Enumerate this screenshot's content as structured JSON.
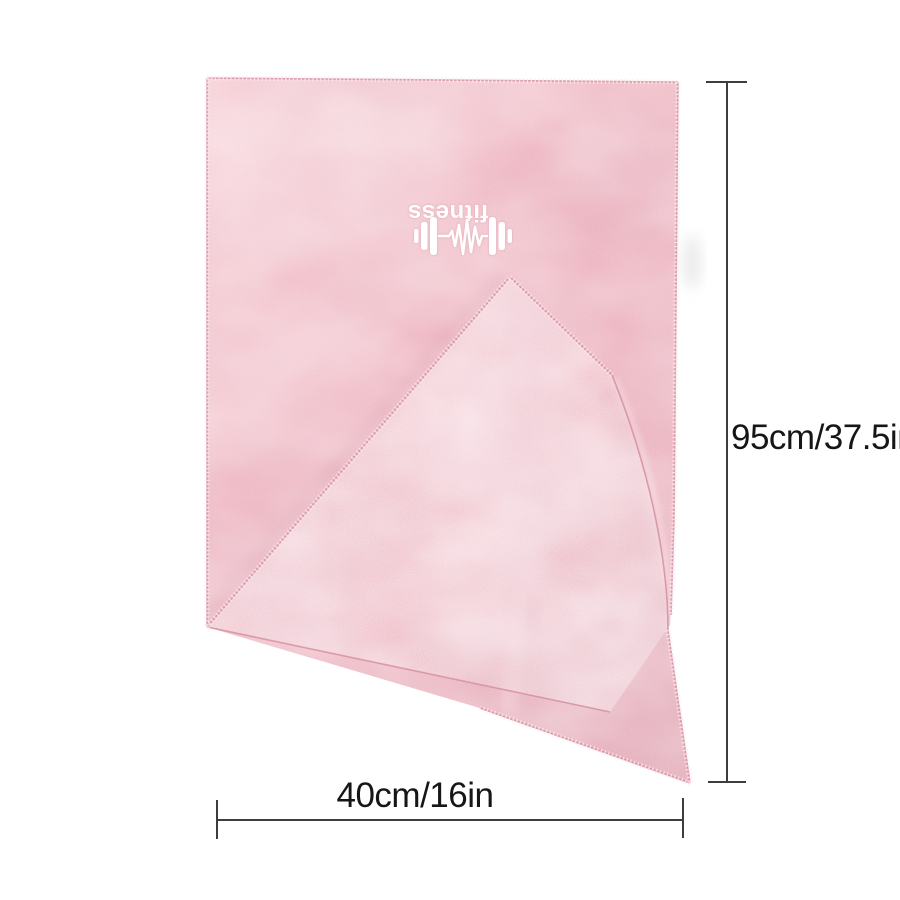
{
  "product": {
    "logo_text": "fitness",
    "logo_icon": "dumbbell-heartbeat-icon"
  },
  "dimensions": {
    "height_label": "95cm/37.5in",
    "width_label": "40cm/16in"
  },
  "colors": {
    "towel_pink": "#eda7b4",
    "towel_pink_light": "#f6c6ce",
    "towel_pink_dark": "#db93a3",
    "embroidery_white": "#ffffff",
    "dimension_line": "#3d3d3d",
    "label_text": "#161616",
    "background": "#ffffff",
    "shadow_gray": "#d9d9d9"
  }
}
